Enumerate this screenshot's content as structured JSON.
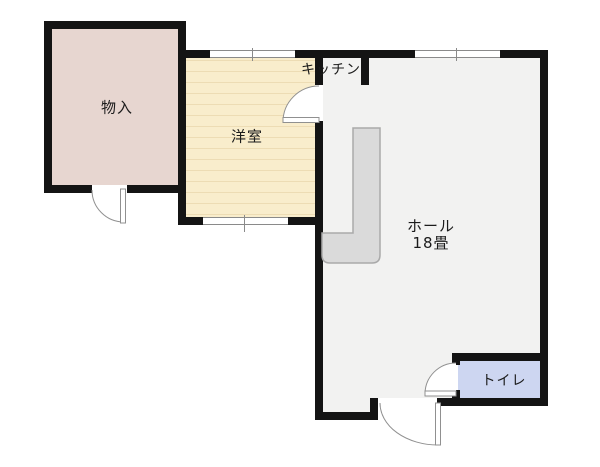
{
  "rooms": {
    "storage": {
      "label": "物入"
    },
    "western": {
      "label": "洋室"
    },
    "kitchen": {
      "label": "キッチン"
    },
    "hall": {
      "label": "ホール",
      "size": "18畳"
    },
    "toilet": {
      "label": "トイレ"
    }
  },
  "colors": {
    "wall": "#141414",
    "storage_fill": "#e7d6d0",
    "western_fill": "#f9edcc",
    "western_stripe": "#eddcb4",
    "kitchen_fill": "#f9edcc",
    "hall_fill": "#f2f2f1",
    "toilet_fill": "#cdd6f1",
    "counter_fill": "#dadada",
    "counter_stroke": "#a9a9a9",
    "door_stroke": "#909090",
    "window_stroke": "#8a8a8a",
    "label_color": "#1b1b1b",
    "background": "#ffffff"
  }
}
